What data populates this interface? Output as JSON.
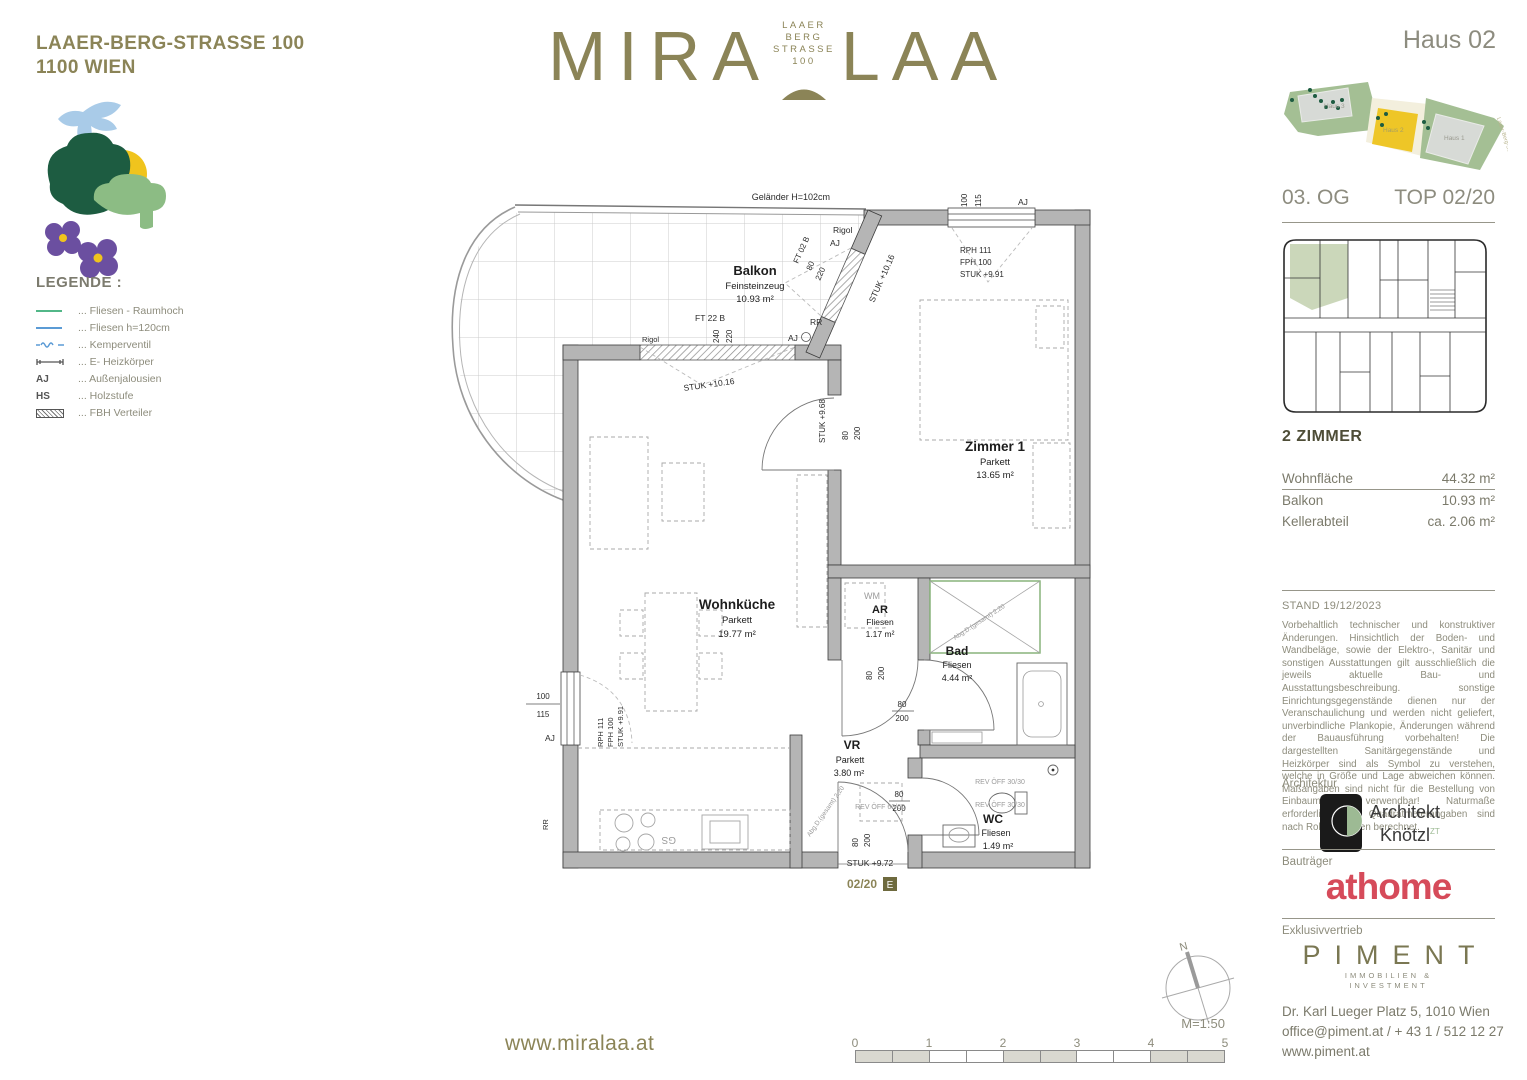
{
  "brand": {
    "address1": "LAAER-BERG-STRASSE 100",
    "address2": "1100 WIEN",
    "logo_left": "MIRA",
    "logo_right": "LAA",
    "logo_sub": [
      "LAAER",
      "BERG",
      "STRASSE",
      "100"
    ]
  },
  "legend": {
    "title": "LEGENDE :",
    "items": [
      {
        "label": "... Fliesen - Raumhoch"
      },
      {
        "label": "... Fliesen h=120cm"
      },
      {
        "label": "... Kemperventil"
      },
      {
        "label": "... E- Heizkörper"
      },
      {
        "label": "... Außenjalousien",
        "sym_text": "AJ"
      },
      {
        "label": "... Holzstufe",
        "sym_text": "HS"
      },
      {
        "label": "... FBH Verteiler"
      }
    ]
  },
  "plan": {
    "gelaender": "Geländer H=102cm",
    "rooms": {
      "balkon": {
        "name": "Balkon",
        "floor": "Feinsteinzeug",
        "area": "10.93 m²"
      },
      "zimmer1": {
        "name": "Zimmer 1",
        "floor": "Parkett",
        "area": "13.65 m²"
      },
      "wohnkueche": {
        "name": "Wohnküche",
        "floor": "Parkett",
        "area": "19.77 m²"
      },
      "ar": {
        "name": "AR",
        "floor": "Fliesen",
        "area": "1.17 m²"
      },
      "bad": {
        "name": "Bad",
        "floor": "Fliesen",
        "area": "4.44 m²"
      },
      "vr": {
        "name": "VR",
        "floor": "Parkett",
        "area": "3.80 m²"
      },
      "wc": {
        "name": "WC",
        "floor": "Fliesen",
        "area": "1.49 m²"
      }
    },
    "labels": {
      "rigol": "Rigol",
      "aj": "AJ",
      "rr": "RR",
      "wm": "WM",
      "gs": "GS",
      "ft02b": "FT 02 B",
      "ft22b": "FT 22 B",
      "d80": "80",
      "d200": "200",
      "d220": "220",
      "d240": "240",
      "d100": "100",
      "d115": "115",
      "stuk1016": "STUK +10.16",
      "stuk991": "STUK +9.91",
      "stuk968": "STUK +9.68",
      "stuk972": "STUK +9.72",
      "rph111": "RPH 111",
      "fph100": "FPH 100",
      "rev6060": "REV ÖFF 60/60",
      "rev3030": "REV ÖFF 30/30",
      "abg": "Abg.D.(gesamt) 2,20",
      "unit": "02/20",
      "unit_letter": "E"
    }
  },
  "panel": {
    "haus": "Haus 02",
    "floor": "03. OG",
    "top": "TOP 02/20",
    "site": {
      "haus1": "Haus 1",
      "haus2": "Haus 2",
      "haus3": "Haus 3",
      "street": "Laaer-Berg-Straße 100"
    },
    "unit_title": "2 ZIMMER",
    "details": [
      {
        "label": "Wohnfläche",
        "value": "44.32 m²"
      },
      {
        "label": "Balkon",
        "value": "10.93 m²"
      },
      {
        "label": "Kellerabteil",
        "value": "ca. 2.06 m²"
      }
    ],
    "stand": "STAND 19/12/2023",
    "disclaimer": "Vorbehaltlich technischer und konstruktiver Änderungen. Hinsichtlich der Boden- und Wandbeläge, sowie der Elektro-, Sanitär und sonstigen Ausstattungen gilt ausschließlich die jeweils aktuelle Bau- und Ausstattungsbeschreibung. sonstige Einrichtungsgegenstände dienen nur der Veranschaulichung und werden nicht geliefert, unverbindliche Plankopie, Änderungen während der Bauausführung vorbehalten! Die dargestellten Sanitärgegenstände und Heizkörper sind als Symbol zu verstehen, welche in Größe und Lage abweichen können. Maßangaben sind nicht für die Bestellung von Einbaumöbel verwendbar! Naturmaße erforderlich! Alle Quadratmeterangaben sind nach Rohbaumaßen berechnet.",
    "architektur_label": "Architektur",
    "architekt_line1": "Architekt",
    "architekt_line2": "Knötzl",
    "architekt_zt": "ZT",
    "bautraeger_label": "Bauträger",
    "bautraeger_logo": "athome",
    "exklusiv_label": "Exklusivvertrieb",
    "piment": "PIMENT",
    "piment_sub1": "IMMOBILIEN &",
    "piment_sub2": "INVESTMENT",
    "address1": "Dr. Karl Lueger Platz 5, 1010 Wien",
    "address2": "office@piment.at / + 43 1 / 512 12 27",
    "address3": "www.piment.at"
  },
  "footer": {
    "website": "www.miralaa.at",
    "scale": "M=1:50",
    "north": "N",
    "ticks": [
      "0",
      "1",
      "2",
      "3",
      "4",
      "5"
    ]
  }
}
